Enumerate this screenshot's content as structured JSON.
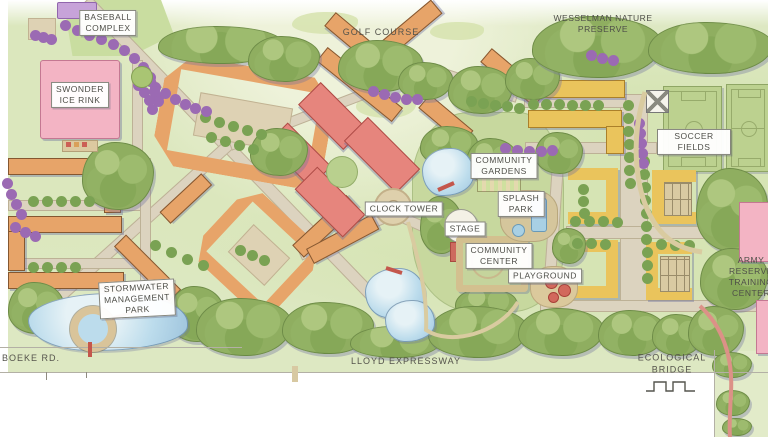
{
  "title": "Community park master plan",
  "labels": {
    "baseball_complex": "BASEBALL\nCOMPLEX",
    "swonder_ice_rink": "SWONDER\nICE RINK",
    "golf_course": "GOLF COURSE",
    "wesselman_nature_preserve": "WESSELMAN NATURE\nPRESERVE",
    "soccer_fields": "SOCCER FIELDS",
    "community_gardens": "COMMUNITY\nGARDENS",
    "splash_park": "SPLASH\nPARK",
    "stage": "STAGE",
    "community_center": "COMMUNITY\nCENTER",
    "playground": "PLAYGROUND",
    "clock_tower": "CLOCK TOWER",
    "stormwater_management_park": "STORMWATER\nMANAGEMENT\nPARK",
    "army_reserve_training_center": "ARMY\nRESERVE\nTRAINING\nCENTER",
    "boeke_rd": "BOEKE RD.",
    "lloyd_expressway": "LLOYD EXPRESSWAY",
    "ecological_bridge": "ECOLOGICAL BRIDGE"
  },
  "palette": {
    "orange_building": "#e7a469",
    "red_building": "#e6857d",
    "yellow_building": "#eac45c",
    "pink_building": "#f3b4c4",
    "water": "#bcdcec",
    "tree_green": "#8fae60",
    "purple_tree": "#9b6ab3",
    "lawn": "#dde8c2",
    "road": "#dcd3bf"
  }
}
